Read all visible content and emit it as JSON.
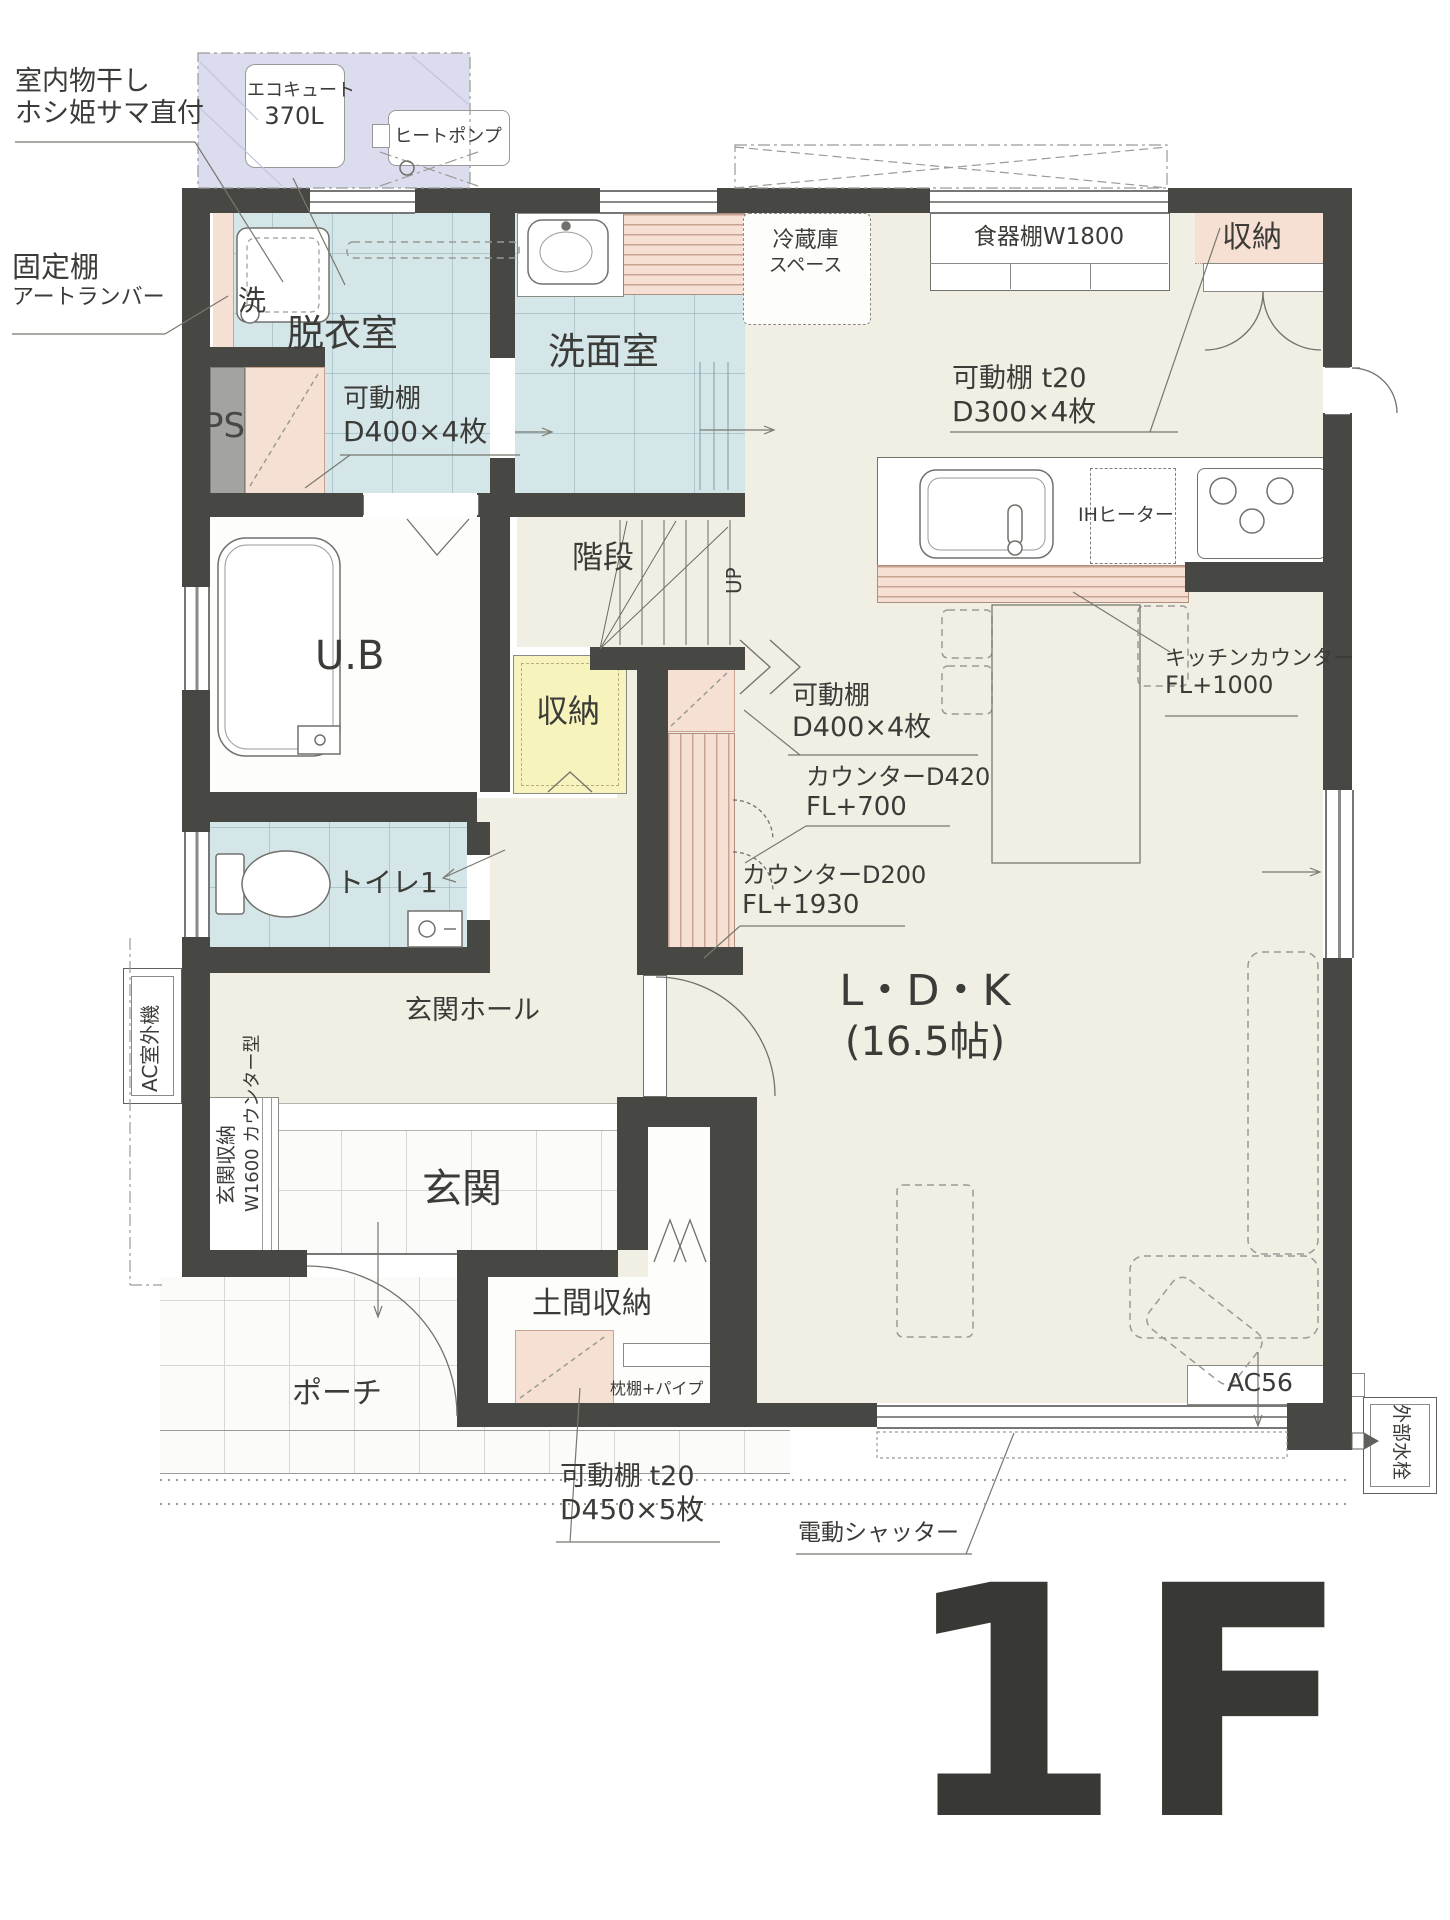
{
  "colors": {
    "wall": "#474744",
    "floor": "#f1eee3",
    "wet_blue": "#d5e6e9",
    "pink": "#f6e0d4",
    "yellow": "#f7f3bd",
    "lavender": "#dcdcef"
  },
  "labels": {
    "indoor_drying_1": "室内物干し",
    "indoor_drying_2": "ホシ姫サマ直付",
    "ecocute_1": "エコキュート",
    "ecocute_2": "370L",
    "heat_pump": "ヒートポンプ",
    "fixed_shelf_1": "固定棚",
    "fixed_shelf_2": "アートランバー",
    "washer": "洗",
    "dressing_room": "脱衣室",
    "ps": "PS",
    "shelf_dressing_1": "可動棚",
    "shelf_dressing_2": "D400×4枚",
    "washroom": "洗面室",
    "stairs": "階段",
    "up": "UP",
    "bath": "U.B",
    "storage_hall": "収納",
    "toilet": "トイレ1",
    "fridge_1": "冷蔵庫",
    "fridge_2": "スペース",
    "dish_cabinet": "食器棚W1800",
    "storage_kitchen": "収納",
    "shelf_ldk_1": "可動棚 t20",
    "shelf_ldk_2": "D300×4枚",
    "ih_heater": "IHヒーター",
    "kitchen_counter_1": "キッチンカウンター",
    "kitchen_counter_2": "FL+1000",
    "shelf_hall_1": "可動棚",
    "shelf_hall_2": "D400×4枚",
    "counter_d420_1": "カウンターD420",
    "counter_d420_2": "FL+700",
    "counter_d200_1": "カウンターD200",
    "counter_d200_2": "FL+1930",
    "ldk_1": "L・D・K",
    "ldk_2": "(16.5帖)",
    "entrance_hall": "玄関ホール",
    "entrance": "玄関",
    "entrance_storage_1": "玄関収納",
    "entrance_storage_2": "W1600 カウンター型",
    "ac_outdoor": "AC室外機",
    "porch": "ポーチ",
    "doma_storage": "土間収納",
    "makura_shelf": "枕棚+パイプ",
    "shelf_doma_1": "可動棚 t20",
    "shelf_doma_2": "D450×5枚",
    "electric_shutter": "電動シャッター",
    "ac56": "AC56",
    "ext_faucet": "外部水栓",
    "floor_tag": "1F"
  }
}
